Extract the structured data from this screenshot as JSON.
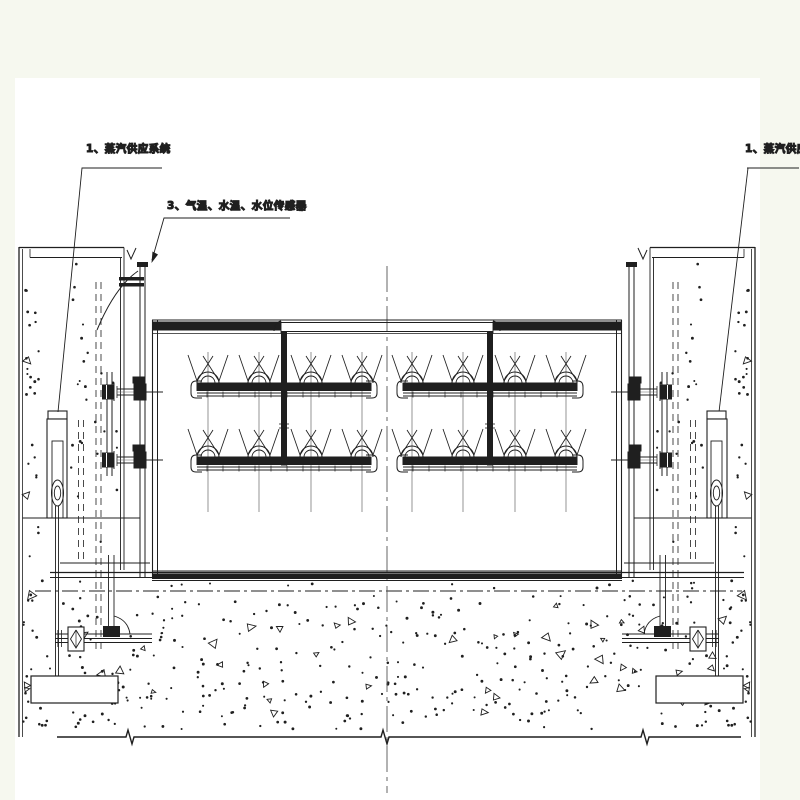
{
  "palette": {
    "background_color": "#f6f8ef",
    "paper_color": "#ffffff",
    "ink_color": "#1f1f1f",
    "thin_line_color": "#666666"
  },
  "annotations": {
    "left_system_label": "1、蒸汽供应系统",
    "sensor_label": "3、气温、水温、水位传感器",
    "right_system_label": "1、蒸汽供应系统"
  },
  "drawing": {
    "centerline_x": 387,
    "nozzle_rows": [
      {
        "pipe_top_y": 383
      },
      {
        "pipe_top_y": 457
      }
    ],
    "pipe_halves": [
      {
        "x1": 197,
        "x2": 371,
        "feed_x": 284,
        "nozzle_centers": [
          208,
          259,
          311,
          362
        ]
      },
      {
        "x1": 403,
        "x2": 577,
        "feed_x": 490,
        "nozzle_centers": [
          412,
          463,
          515,
          566
        ]
      }
    ],
    "guide_line_span": [
      352,
      512
    ],
    "stipple": {
      "slab_dots": 340,
      "slab_triangles": 42
    }
  }
}
